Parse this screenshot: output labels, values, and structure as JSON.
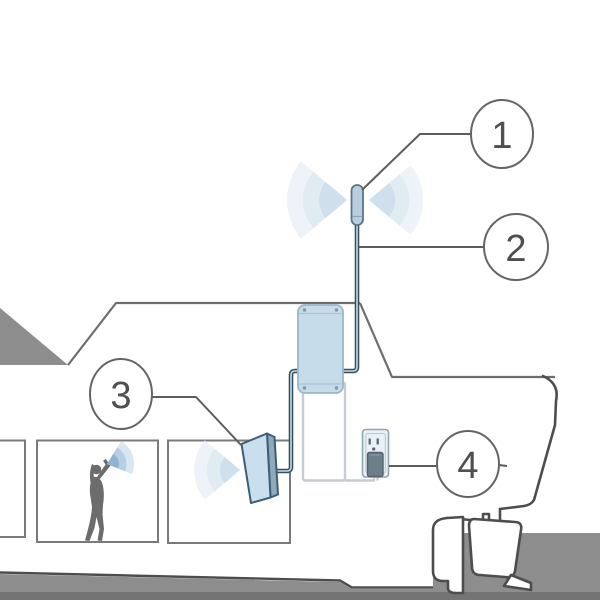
{
  "diagram": {
    "title": "boat-signal-booster-installation",
    "callouts": [
      {
        "label": "1",
        "target": "outside-antenna"
      },
      {
        "label": "2",
        "target": "coax-cable"
      },
      {
        "label": "3",
        "target": "inside-antenna"
      },
      {
        "label": "4",
        "target": "power-plug"
      }
    ],
    "icons": [
      "outside-antenna-icon",
      "signal-waves-icon",
      "coax-cable-icon",
      "booster-unit-icon",
      "inside-panel-antenna-icon",
      "power-outlet-icon",
      "power-plug-icon",
      "person-on-phone-icon",
      "boat-outline-icon"
    ],
    "colors": {
      "background": "#ffffff",
      "ground_gray": "#8d8d8d",
      "ground_dark_band": "#747474",
      "outline_gray": "#6d6d6d",
      "stern_outline": "#4d4d4d",
      "window_stroke": "#7a7a7a",
      "coax_outer": "#35505f",
      "coax_core": "#c3d9e8",
      "device_fill": "#c7dcea",
      "device_stroke": "#9db7c8",
      "antenna_fill": "#b7cedd",
      "antenna_stroke": "#5c7487",
      "panel_fill": "#c9dfee",
      "panel_side": "#8fa9bc",
      "panel_stroke": "#3f5d72",
      "outlet_fill": "#e9f0f6",
      "outlet_stroke": "#91a6b3",
      "plug_fill": "#6d7e8b",
      "cord_gray": "#c6ccd1",
      "wave_faint_1": "#edf3f8",
      "wave_faint_2": "#e0ebf2",
      "wave_faint_3": "#cfe0ec",
      "wave_phone_1": "#d9e7f2",
      "wave_phone_2": "#b5cfe4",
      "wave_phone_3": "#8fb4d3",
      "callout_stroke": "#646464",
      "callout_text": "#4f4f4f",
      "silhouette": "#6c6c6c"
    }
  }
}
